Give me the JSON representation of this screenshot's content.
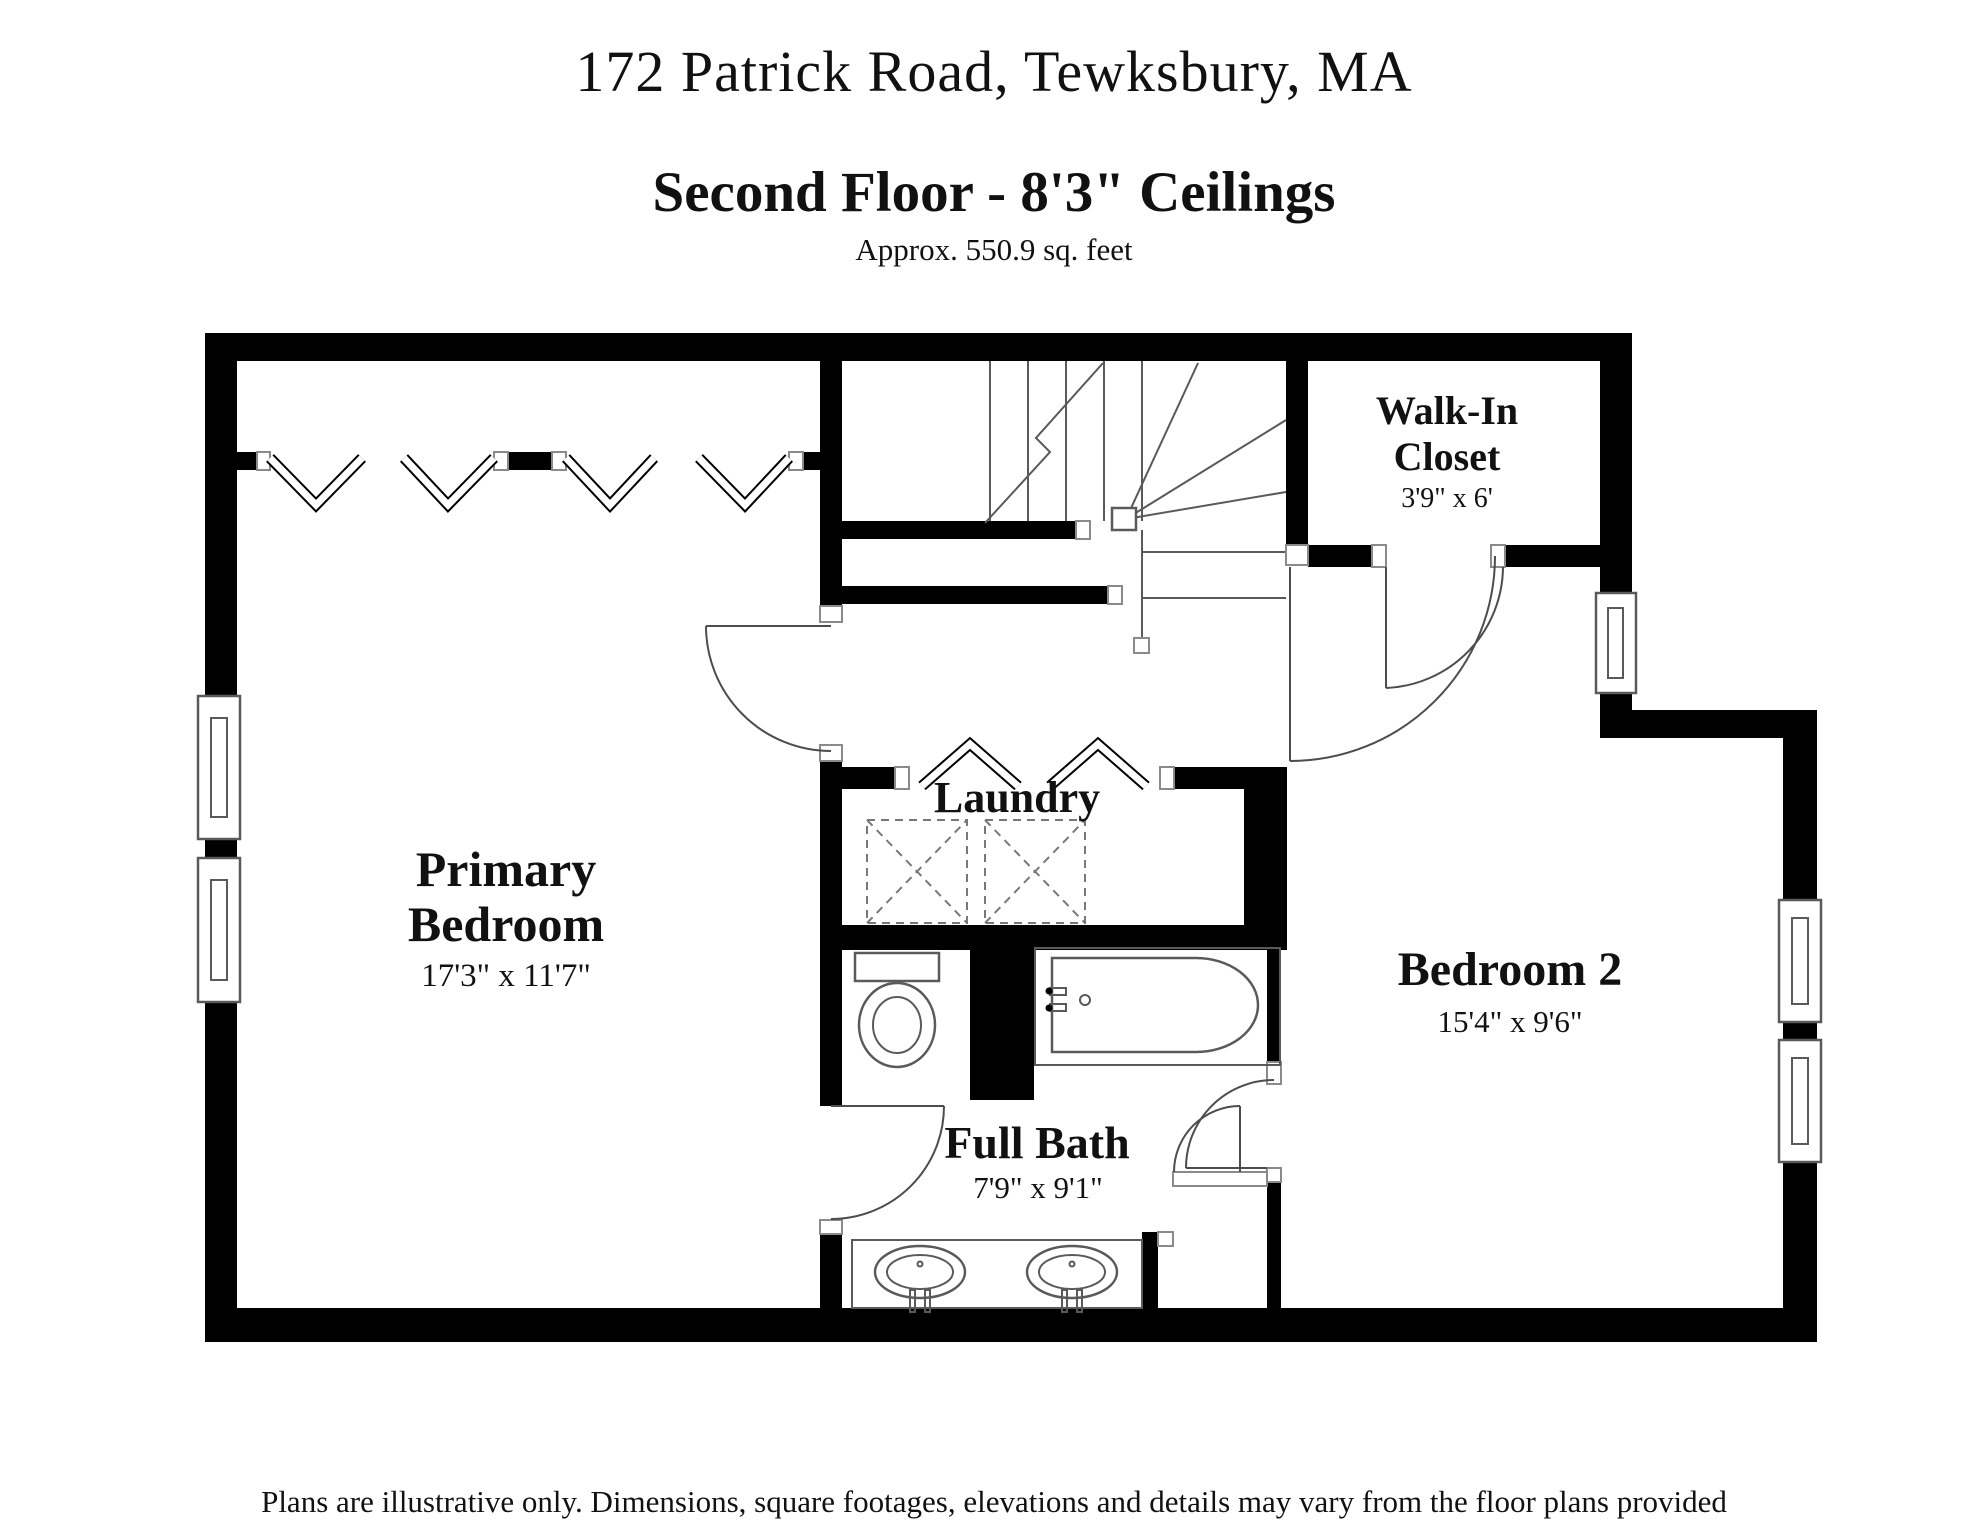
{
  "header": {
    "address": "172 Patrick Road, Tewksbury, MA",
    "floor_title": "Second Floor - 8'3\" Ceilings",
    "area_note": "Approx. 550.9 sq. feet"
  },
  "rooms": {
    "primary_bedroom": {
      "name_line1": "Primary",
      "name_line2": "Bedroom",
      "dimensions": "17'3\" x 11'7\""
    },
    "walk_in_closet": {
      "name_line1": "Walk-In",
      "name_line2": "Closet",
      "dimensions": "3'9\" x 6'"
    },
    "laundry": {
      "name": "Laundry"
    },
    "full_bath": {
      "name": "Full Bath",
      "dimensions": "7'9\" x 9'1\""
    },
    "bedroom_2": {
      "name": "Bedroom 2",
      "dimensions": "15'4\" x 9'6\""
    }
  },
  "footer": {
    "disclaimer": "Plans are illustrative only. Dimensions, square footages, elevations and details may vary from the floor plans provided"
  },
  "colors": {
    "wall": "#000000",
    "fixture_line": "#5a5a5a",
    "background": "#ffffff"
  }
}
